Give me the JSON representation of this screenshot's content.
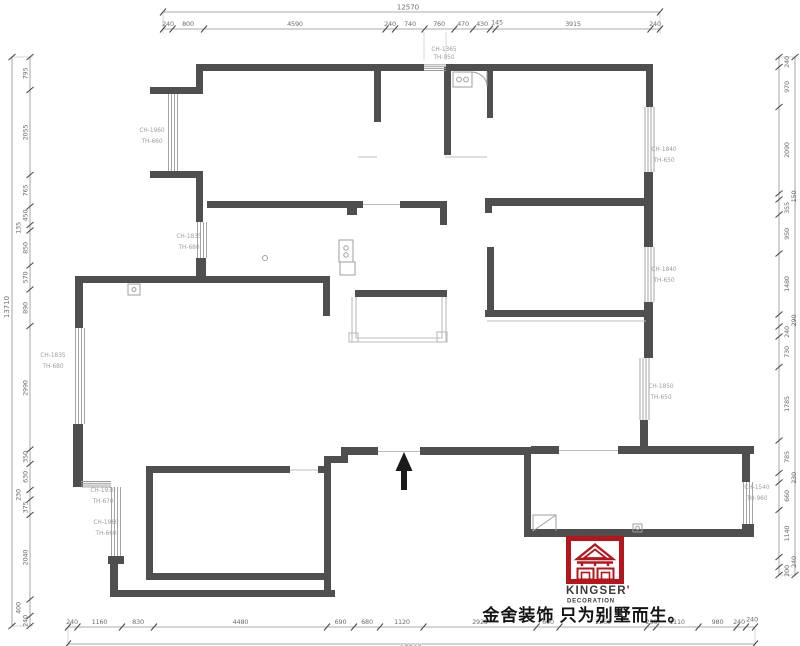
{
  "drawing": {
    "type": "residential floor plan"
  },
  "dims": {
    "top": {
      "total": "12570",
      "segments": [
        "240",
        "800",
        "4590",
        "240",
        "740",
        "760",
        "470",
        "430",
        "145",
        "3915",
        "240"
      ]
    },
    "left": {
      "total": "13710",
      "segments": [
        "795",
        "2055",
        "765",
        "450",
        "135",
        "850",
        "570",
        "890",
        "2990",
        "350",
        "630",
        "230",
        "375",
        "2040",
        "400",
        "240"
      ]
    },
    "right": {
      "segments": [
        "240",
        "970",
        "2090",
        "150",
        "355",
        "950",
        "1480",
        "290",
        "240",
        "730",
        "1785",
        "785",
        "230",
        "660",
        "1140",
        "240",
        "200"
      ]
    },
    "bottom": {
      "total": "17785",
      "segments": [
        "240",
        "1160",
        "830",
        "4480",
        "690",
        "680",
        "1120",
        "2925",
        "600",
        "2260",
        "230",
        "1110",
        "980",
        "240",
        "240"
      ]
    }
  },
  "openings": [
    {
      "ch": "CH-1365",
      "th": "TH-950"
    },
    {
      "ch": "CH-1960",
      "th": "TH-660"
    },
    {
      "ch": "CH-1835",
      "th": "TH-680"
    },
    {
      "ch": "CH-1840",
      "th": "TH-650"
    },
    {
      "ch": "CH-1840",
      "th": "TH-650"
    },
    {
      "ch": "CH-1850",
      "th": "TH-650"
    },
    {
      "ch": "CH-1835",
      "th": "TH-680"
    },
    {
      "ch": "CH-1930",
      "th": "TH-670"
    },
    {
      "ch": "CH-1960",
      "th": "TH-660"
    },
    {
      "ch": "CH-1540",
      "th": "TH-960"
    }
  ],
  "logo": {
    "brand": "KINGSER",
    "mark": "'",
    "subtitle": "DECORATION"
  },
  "slogan": "金舍装饰 只为别墅而生。",
  "colors": {
    "wall": "#4f4f4f",
    "window": "#9a9a9a",
    "dim_text": "#6e6e6e",
    "logo_red": "#b5161c",
    "logo_text": "#3c3c3c",
    "slogan": "#141414"
  }
}
